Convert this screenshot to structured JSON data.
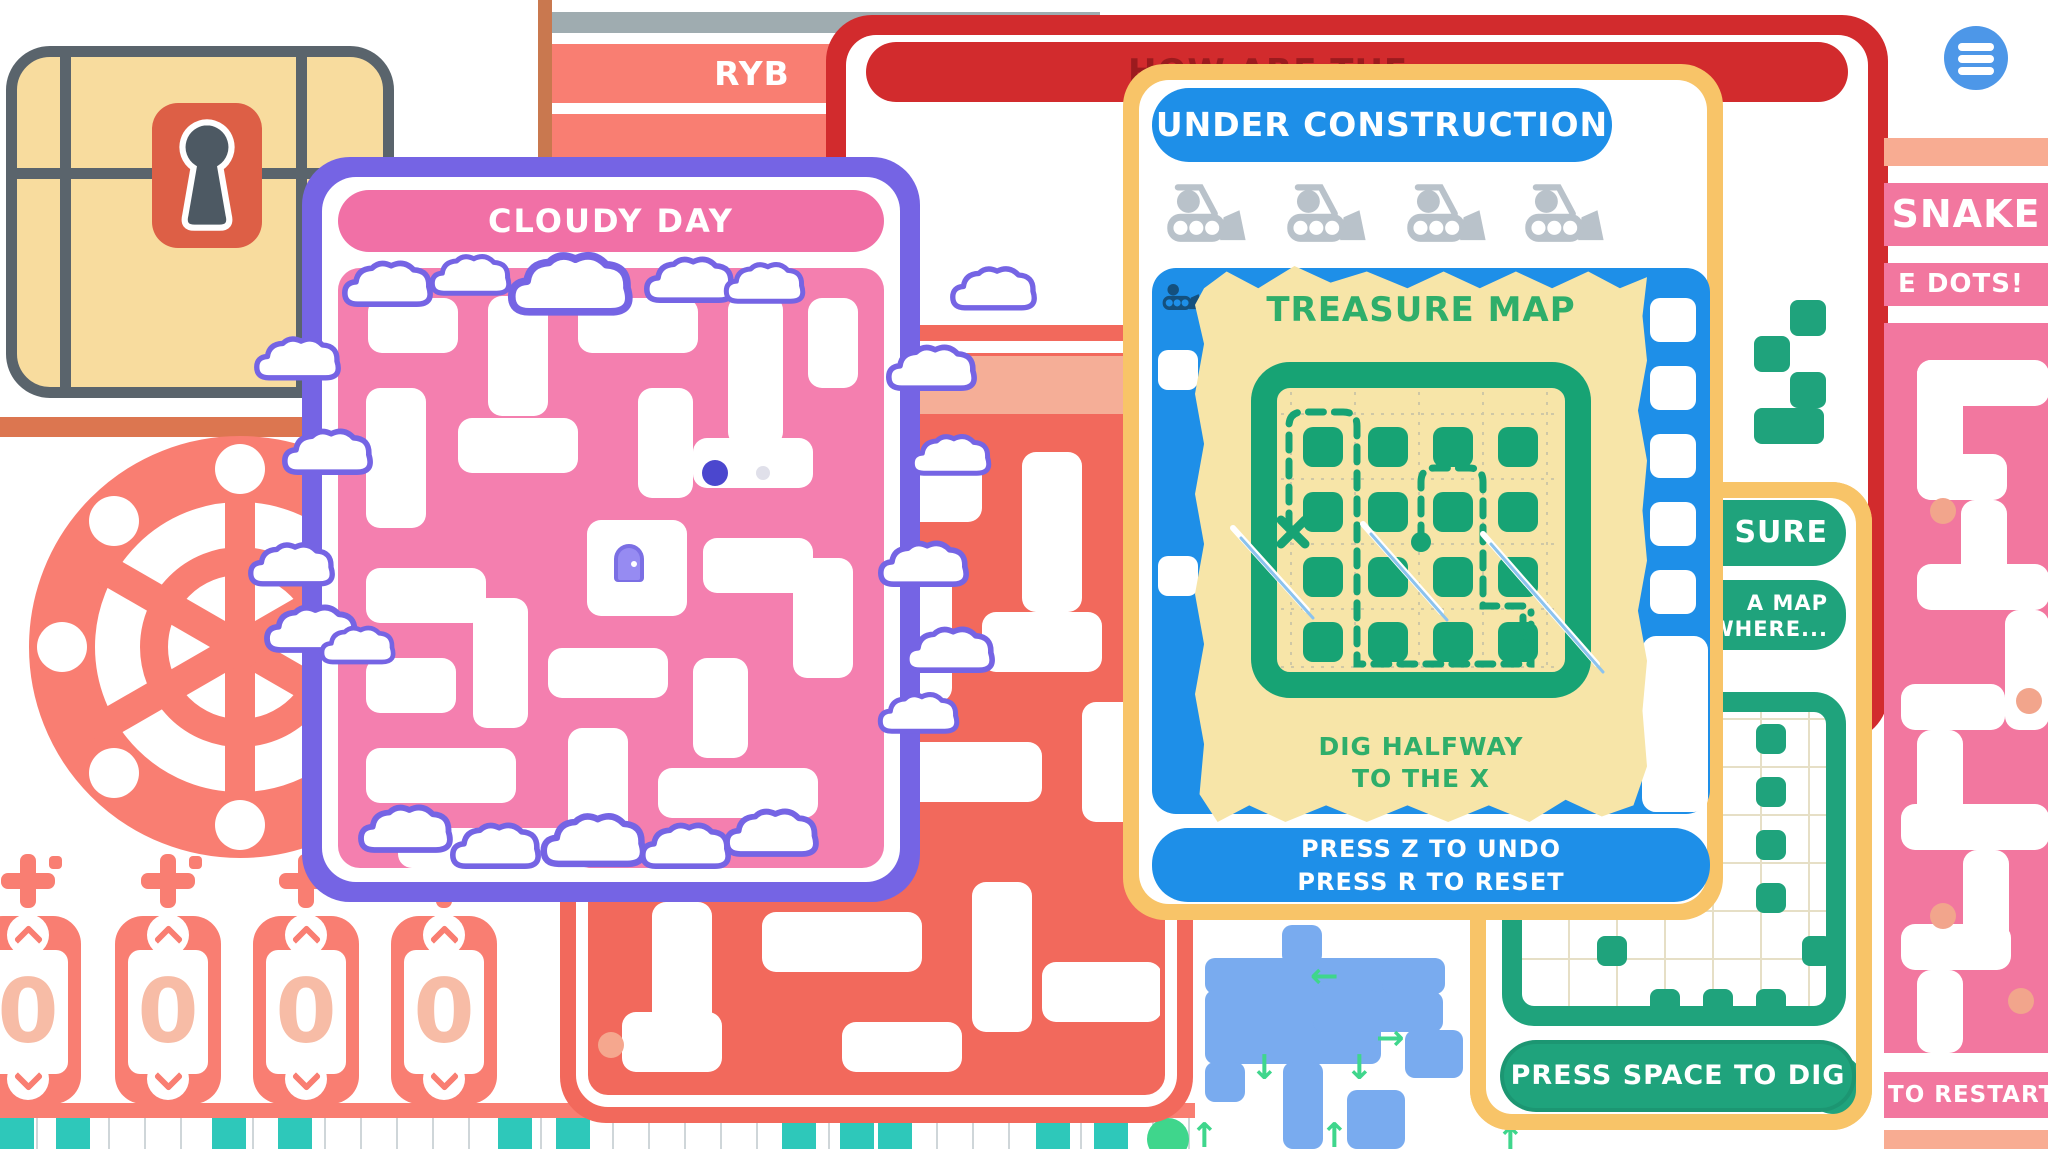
{
  "windows": {
    "vault": {
      "counters": [
        "0",
        "0",
        "0",
        "0"
      ]
    },
    "ryb": {
      "title": "RYB"
    },
    "red": {
      "partial_title": "HOW ARE THE..."
    },
    "cloudy": {
      "title": "CLOUDY DAY"
    },
    "construction": {
      "title": "UNDER CONSTRUCTION",
      "treasure_map": {
        "title": "TREASURE MAP",
        "hint": [
          "DIG HALFWAY",
          "TO THE X"
        ]
      },
      "footer": [
        "PRESS Z TO UNDO",
        "PRESS R TO RESET"
      ]
    },
    "dig": {
      "partial_title": "SURE",
      "partial_hint": [
        "A MAP",
        "WHERE..."
      ],
      "action": "PRESS SPACE TO DIG"
    },
    "snake": {
      "title": "SNAKE",
      "partial_subtitle": "E DOTS!",
      "partial_footer": "TO RESTART"
    }
  },
  "icons": {
    "arrow_left": "←",
    "arrow_right": "→",
    "arrow_up": "↑",
    "arrow_down": "↓"
  },
  "colors": {
    "coral": "#F97E72",
    "salmon": "#F2695C",
    "pink": "#F478AC",
    "purple": "#7564E4",
    "red": "#D22B2D",
    "yellow": "#F8C468",
    "blue": "#1E8FE8",
    "cornflower": "#79ABEF",
    "green": "#1FA37C",
    "map_green": "#17A374",
    "parchment": "#F7E5A8",
    "teal": "#2EC8BA",
    "slate": "#5A646C"
  }
}
